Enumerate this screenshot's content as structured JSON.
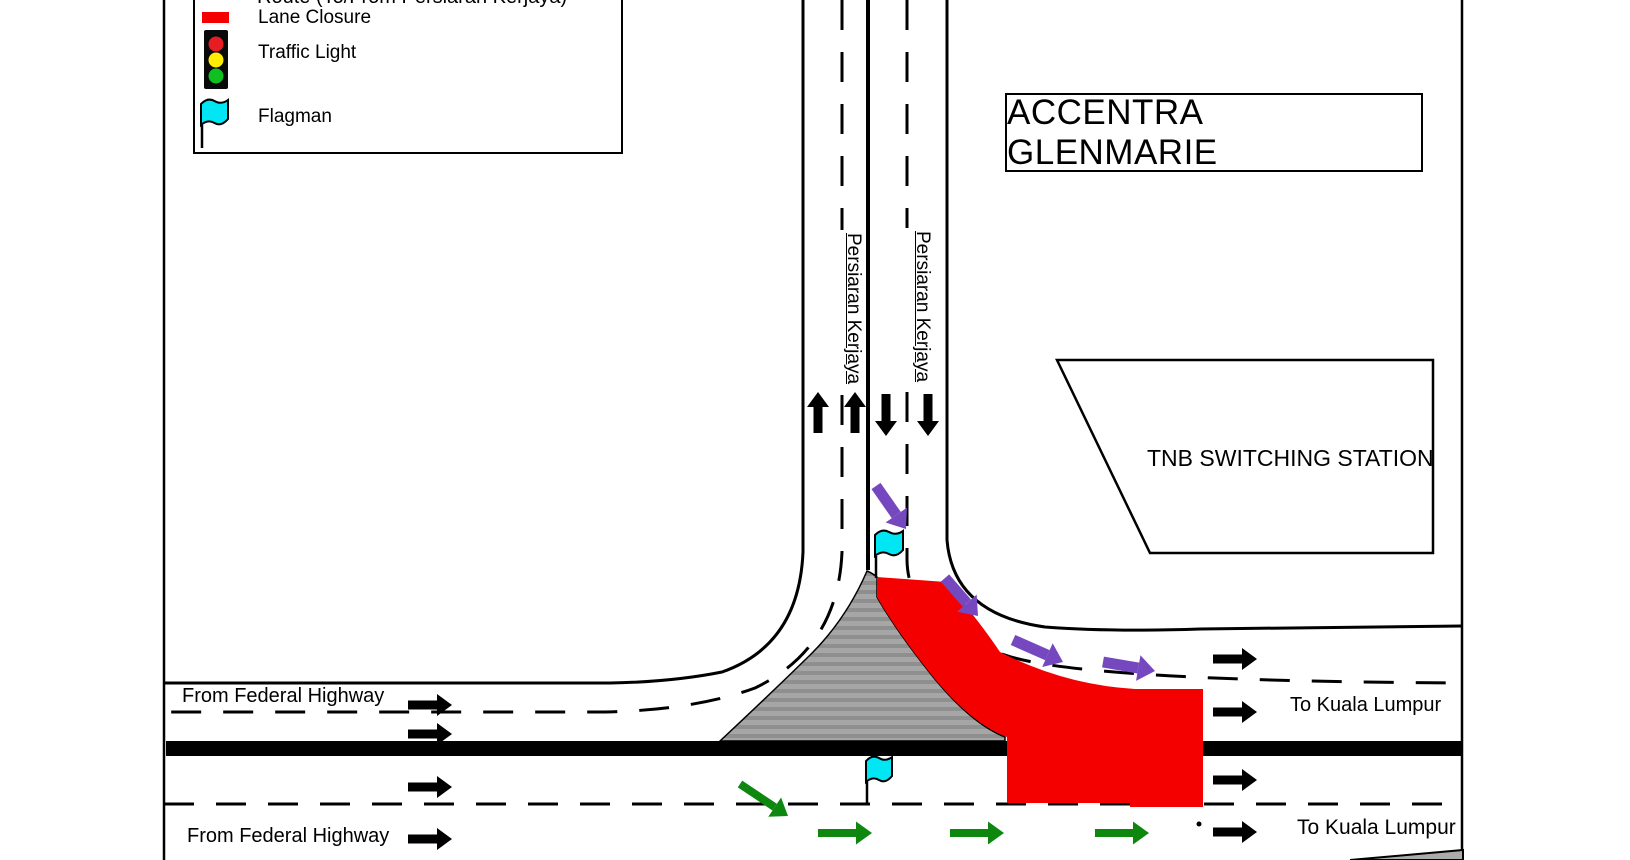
{
  "buildings": {
    "accentra": "ACCENTRA GLENMARIE",
    "tnb": "TNB SWITCHING STATION"
  },
  "legend": {
    "partial_item_label": "Route (To/From Persiaran Kerjaya)",
    "items": [
      {
        "label": "Lane Closure"
      },
      {
        "label": "Traffic Light"
      },
      {
        "label": "Flagman"
      }
    ]
  },
  "roads": {
    "persiaran_kerjaya": "Persiaran Kerjaya",
    "from_federal_highway": "From Federal Highway",
    "to_kuala_lumpur": "To Kuala Lumpur"
  },
  "colors": {
    "lane_closure_red": "#F40000",
    "flag_cyan": "#00E6F2",
    "diverted_purple": "#7648C0",
    "route_green": "#0E870E",
    "island_gray": "#9C9C9C",
    "traffic_light_red": "#E81D23",
    "traffic_light_yellow": "#FFEC00",
    "traffic_light_green": "#10C020"
  }
}
